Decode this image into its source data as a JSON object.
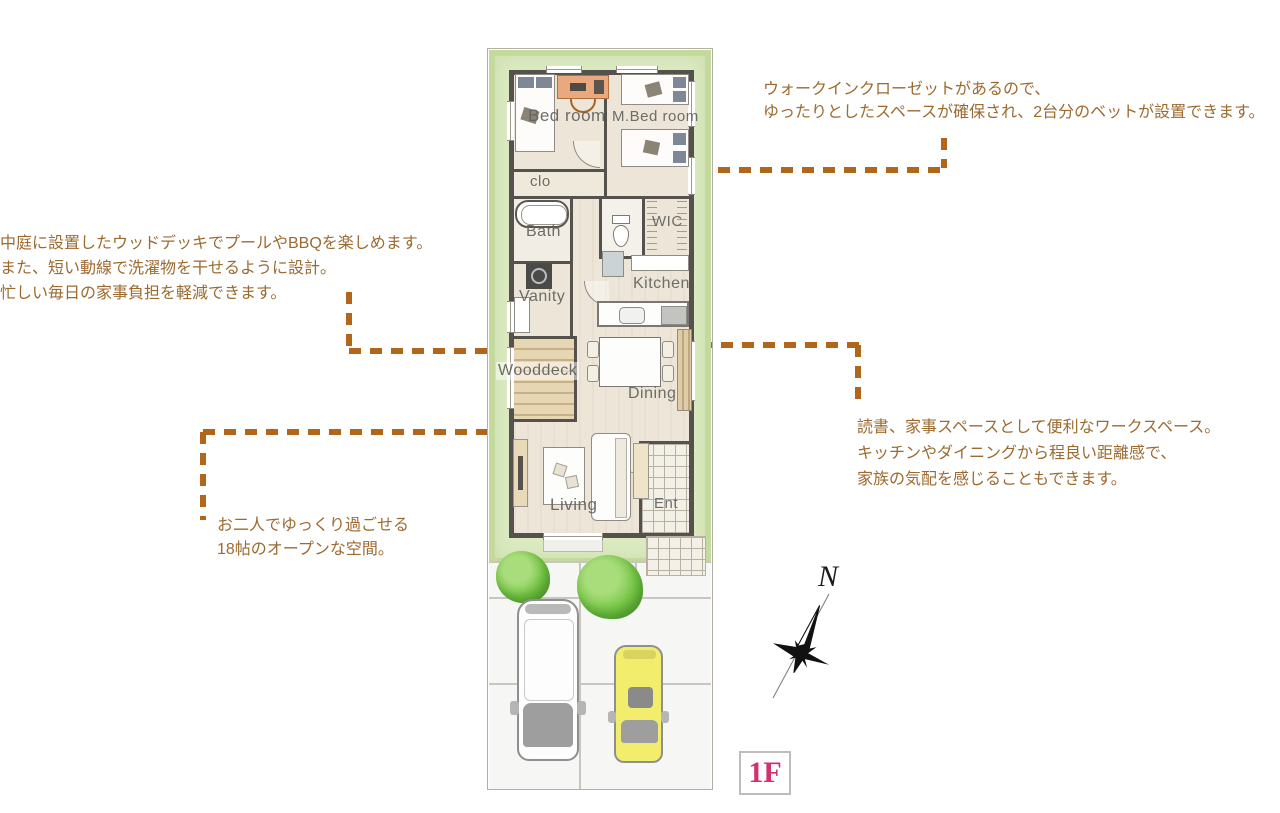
{
  "annotations": [
    {
      "id": "wic",
      "lines": [
        "ウォークインクローゼットがあるので、",
        "ゆったりとしたスペースが確保され、2台分のベットが設置できます。"
      ]
    },
    {
      "id": "wooddeck",
      "lines": [
        "中庭に設置したウッドデッキでプールやBBQを楽しめます。",
        "また、短い動線で洗濯物を干せるように設計。",
        "忙しい毎日の家事負担を軽減できます。"
      ]
    },
    {
      "id": "workspace",
      "lines": [
        "読書、家事スペースとして便利なワークスペース。",
        "キッチンやダイニングから程良い距離感で、",
        "家族の気配を感じることもできます。"
      ]
    },
    {
      "id": "living",
      "lines": [
        "お二人でゆっくり過ごせる",
        "18帖のオープンな空間。"
      ]
    }
  ],
  "plan": {
    "rooms": {
      "bedroom": "Bed room",
      "mbedroom": "M.Bed room",
      "clo": "clo",
      "bath": "Bath",
      "wic": "WIC",
      "vanity": "Vanity",
      "kitchen": "Kitchen",
      "wooddeck": "Wooddeck",
      "dining": "Dining",
      "living": "Living",
      "ent": "Ent"
    }
  },
  "compass": {
    "north_label": "N"
  },
  "floor_badge": {
    "label": "1F"
  },
  "colors": {
    "accent_dash": "#b2661c",
    "annotation_text": "#9c6a2f",
    "lawn": "#dcebc2",
    "wall": "#55524d",
    "floor": "#ede6d8",
    "badge_pink": "#d23070",
    "tree_green": "#6fbf44",
    "car_yellow": "#f2ed6d"
  }
}
